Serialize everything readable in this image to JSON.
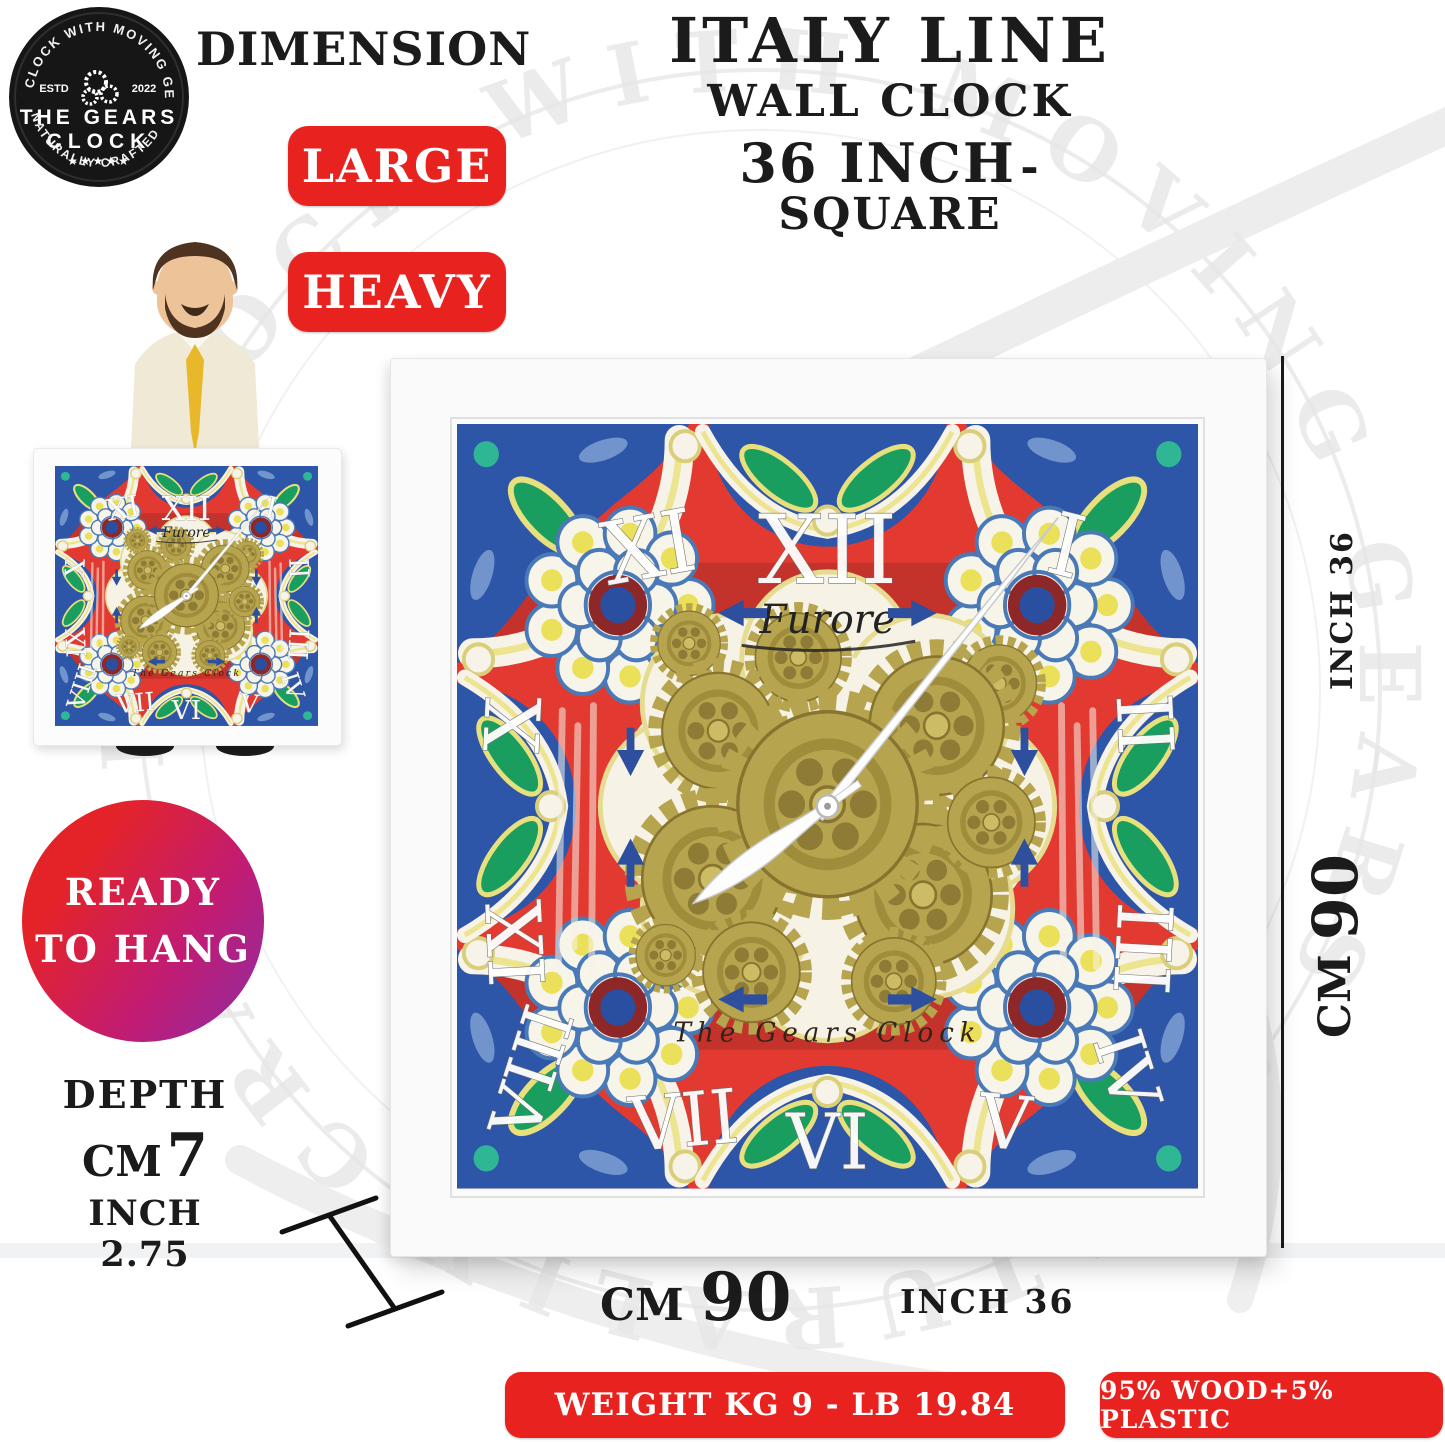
{
  "logo": {
    "arc_top": "CLOCK WITH MOVING GEARS",
    "estd": "ESTD",
    "year": "2022",
    "title1": "THE GEARS",
    "title2": "CLOCK",
    "stars": "★★★★★",
    "arc_bottom": "NATURALLY CRAFTED"
  },
  "header": {
    "dimension": "DIMENSION",
    "italy": "ITALY LINE",
    "wall": "WALL CLOCK",
    "size_main": "36 INCH",
    "size_suffix": "- SQUARE"
  },
  "badges": {
    "large": "LARGE",
    "heavy": "HEAVY"
  },
  "ready": {
    "line1": "READY",
    "line2": "TO HANG"
  },
  "depth": {
    "label": "DEPTH",
    "cm_unit": "CM",
    "cm_value": "7",
    "inch_unit": "INCH",
    "inch_value": "2.75"
  },
  "side_dims": {
    "inch": "INCH 36",
    "cm_unit": "CM",
    "cm_value": "90"
  },
  "bottom_dims": {
    "cm_unit": "CM",
    "cm_value": "90",
    "inch": "INCH 36"
  },
  "footer": {
    "weight": "WEIGHT KG 9 - LB 19.84",
    "material": "95% WOOD+5% PLASTIC"
  },
  "clock": {
    "brand": "Furore",
    "maker": "The Gears Clock",
    "numerals": {
      "n12": "XII",
      "n11": "XI",
      "n1": "I",
      "n10": "X",
      "n9": "IX",
      "n2": "II",
      "n3": "III",
      "n8": "VIII",
      "n7": "VII",
      "n6": "VI",
      "n5": "V",
      "n4": "IV"
    }
  },
  "watermark": {
    "text": "CLOCK WITH MOVING GEARS · NATURALLY CRAFTED ·"
  },
  "colors": {
    "badge_red": "#e8231f",
    "tile_red": "#e23a31",
    "tile_blue": "#2d55a8",
    "tile_green": "#1a9e5f",
    "tile_yellow": "#ece48f",
    "gear_gold": "#b7a44e",
    "gradient_purple": "#8b2da4",
    "frame_white": "#fbfafa"
  }
}
